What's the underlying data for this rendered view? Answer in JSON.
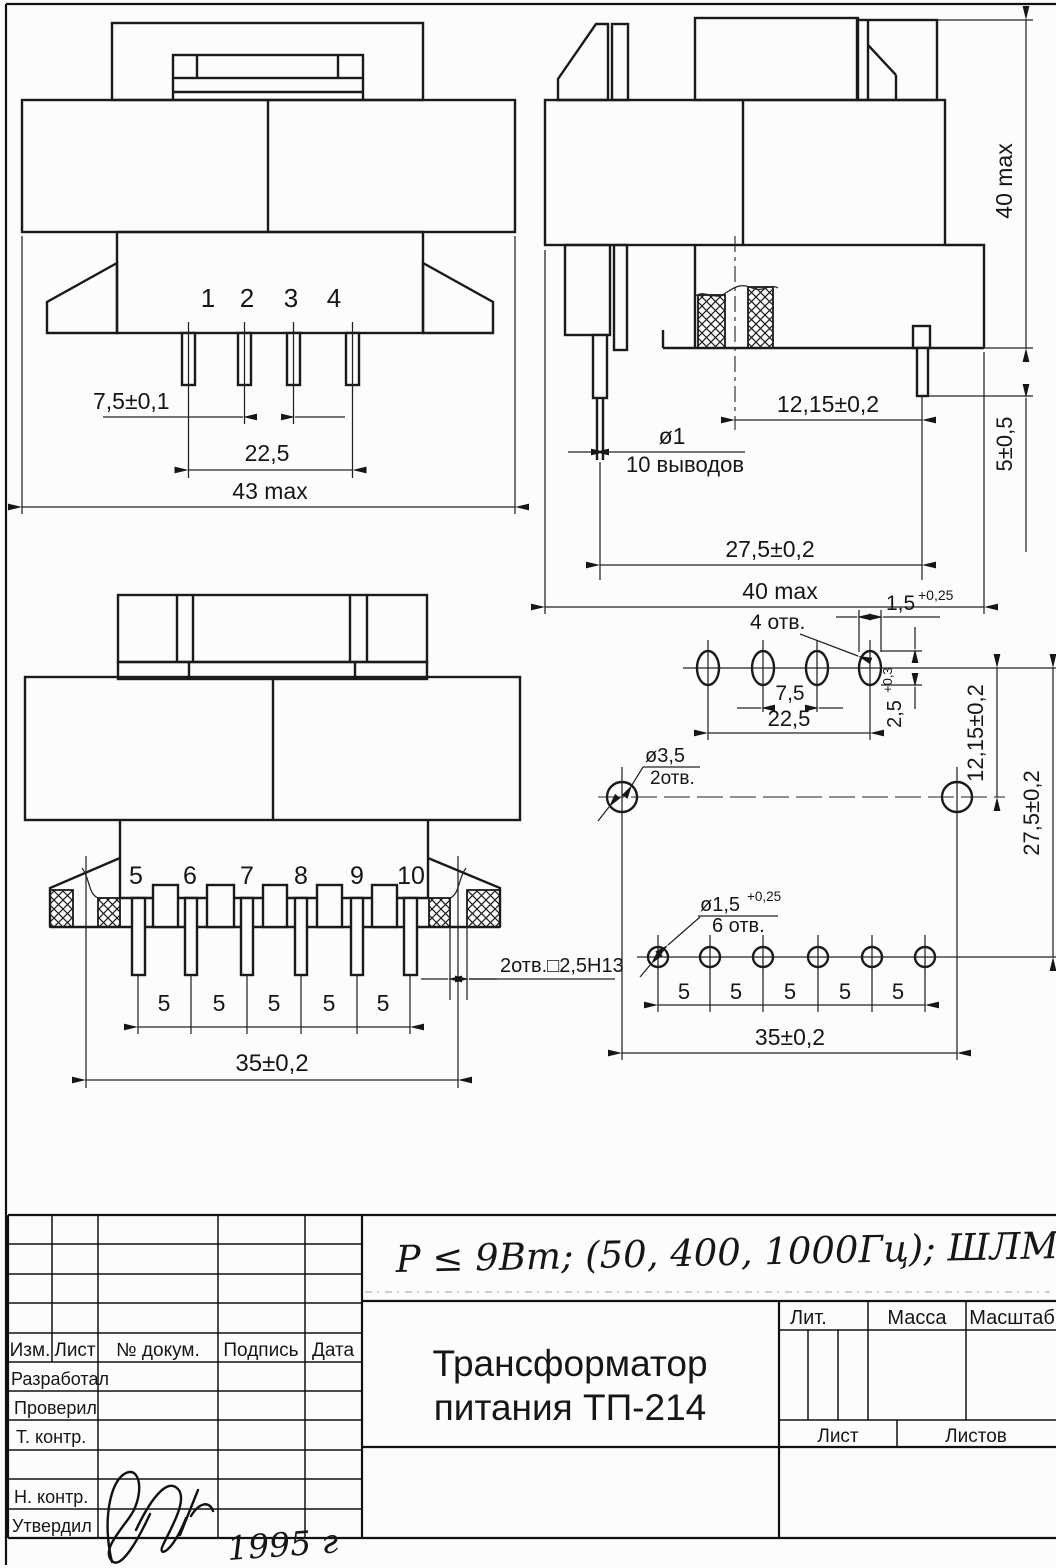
{
  "front_view": {
    "pins": [
      "1",
      "2",
      "3",
      "4"
    ],
    "dim_pin_pitch": "7,5±0,1",
    "dim_pin_span": "22,5",
    "dim_width": "43 max"
  },
  "side_view": {
    "dim_height": "40 max",
    "dim_pin_length": "5±0,5",
    "dim_row_offset": "12,15±0,2",
    "pin_dia": "ø1",
    "pin_count": "10 выводов",
    "dim_row_spacing": "27,5±0,2",
    "dim_depth": "40 max"
  },
  "rear_view": {
    "pins": [
      "5",
      "6",
      "7",
      "8",
      "9",
      "10"
    ],
    "pitches": [
      "5",
      "5",
      "5",
      "5",
      "5"
    ],
    "dim_hole_span": "35±0,2",
    "slot_note": "2отв.□2,5Н13"
  },
  "footprint": {
    "slots_count": "4 отв.",
    "slot_width": "1,5",
    "slot_width_tol": "+0,25",
    "slot_pitch": "7,5",
    "slot_span": "22,5",
    "slot_height": "2,5",
    "slot_height_tol": "+0,3",
    "big_hole_dia": "ø3,5",
    "big_hole_count": "2отв.",
    "small_hole_dia": "ø1,5",
    "small_hole_tol": "+0,25",
    "small_hole_count": "6 отв.",
    "pitches": [
      "5",
      "5",
      "5",
      "5",
      "5"
    ],
    "dim_row_offset": "12,15±0,2",
    "dim_row_spacing": "27,5±0,2",
    "dim_hole_span": "35±0,2"
  },
  "title_block": {
    "columns": [
      "Изм.",
      "Лист",
      "№ докум.",
      "Подпись",
      "Дата"
    ],
    "roles": [
      "Разработал",
      "Проверил",
      "Т. контр.",
      "Н. контр.",
      "Утвердил"
    ],
    "title_line1": "Трансформатор",
    "title_line2": "питания ТП-214",
    "lit_label": "Лит.",
    "mass_label": "Масса",
    "scale_label": "Масштаб",
    "sheet_label": "Лист",
    "sheets_label": "Листов"
  },
  "annotations": {
    "spec_note": "P ≤ 9Вт; (50, 400, 1000Гц); ШЛМ12×20 |",
    "year_note": "1995 г"
  }
}
